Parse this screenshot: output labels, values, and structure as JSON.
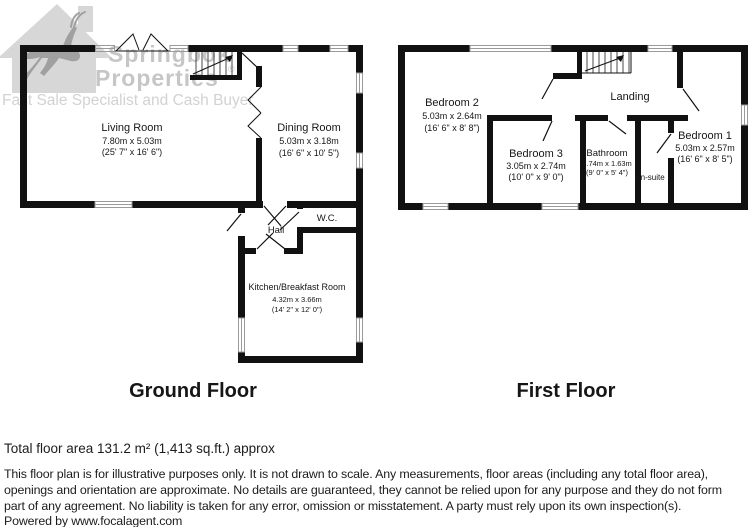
{
  "watermark": {
    "brand_top": "Springbok",
    "brand_bottom": "Properties",
    "reg": "®",
    "tagline": "Fast Sale Specialist and Cash Buyer"
  },
  "ground_floor": {
    "title": "Ground Floor",
    "living": {
      "name": "Living Room",
      "m": "7.80m x 5.03m",
      "ft": "(25' 7\" x 16' 6\")"
    },
    "dining": {
      "name": "Dining Room",
      "m": "5.03m x 3.18m",
      "ft": "(16' 6\" x 10' 5\")"
    },
    "hall": {
      "name": "Hall"
    },
    "wc": {
      "name": "W.C."
    },
    "kitchen": {
      "name": "Kitchen/Breakfast Room",
      "m": "4.32m x 3.66m",
      "ft": "(14' 2\" x 12' 0\")"
    }
  },
  "first_floor": {
    "title": "First Floor",
    "bedroom2": {
      "name": "Bedroom 2",
      "m": "5.03m x 2.64m",
      "ft": "(16' 6\" x 8' 8\")"
    },
    "landing": {
      "name": "Landing"
    },
    "bedroom3": {
      "name": "Bedroom 3",
      "m": "3.05m x 2.74m",
      "ft": "(10' 0\" x 9' 0\")"
    },
    "bathroom": {
      "name": "Bathroom",
      "m": "2.74m x 1.63m",
      "ft": "(9' 0\" x 5' 4\")"
    },
    "ensuite": {
      "name": "En-suite"
    },
    "bedroom1": {
      "name": "Bedroom 1",
      "m": "5.03m x 2.57m",
      "ft": "(16' 6\" x 8' 5\")"
    }
  },
  "footer": {
    "total_area": "Total floor area 131.2 m² (1,413 sq.ft.) approx",
    "disclaimer_lines": [
      "This floor plan is for illustrative purposes only. It is not drawn to scale. Any measurements, floor areas (including any total floor area),",
      "openings and orientation are approximate. No details are guaranteed, they cannot be relied upon for any purpose and they do not form",
      "part of any agreement. No liability is taken for any error, omission or misstatement. A party must rely upon its own inspection(s)."
    ],
    "powered_by": "Powered by www.focalagent.com"
  },
  "colors": {
    "wall": "#111111",
    "window_frame": "#9a9a9a",
    "watermark_house": "#d7d7d7",
    "watermark_animal": "#a0a0a0",
    "watermark_text": "#c6c6c6",
    "watermark_tagline": "#d2d2d2",
    "text": "#1c1c1c",
    "background": "#ffffff"
  }
}
